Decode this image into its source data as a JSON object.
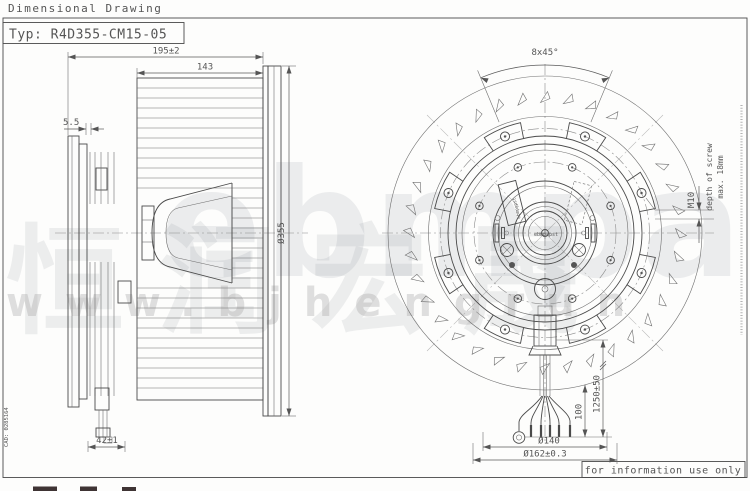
{
  "header": {
    "title": "Dimensional Drawing",
    "type_label": "Typ: R4D355-CM15-05"
  },
  "side_view": {
    "dim_total_depth": "195±2",
    "dim_impeller_depth": "143",
    "dim_inlet_gap": "5.5",
    "dim_outer_diameter": "Ø355",
    "dim_cable_offset": "42±1"
  },
  "front_view": {
    "dim_chamfer": "8x45°",
    "dim_mounting_thread": "M10",
    "mounting_note_line1": "depth of screw",
    "mounting_note_line2": "max. 18mm",
    "dim_lead_strip": "100",
    "dim_cable_length": "1250±50",
    "dim_pitch_circle": "Ø140",
    "dim_spigot": "Ø162±0.3",
    "hub_plate_label": "ebmpapst",
    "center_cap_label": "ebmpapst"
  },
  "footer": {
    "info_note": "for information use only",
    "cad_ref": "CAD: 0285164"
  },
  "watermark": {
    "brand_text": "ebmpapst",
    "cn_text": "恒润宏晟",
    "url_text": "www.bjhengrun"
  }
}
